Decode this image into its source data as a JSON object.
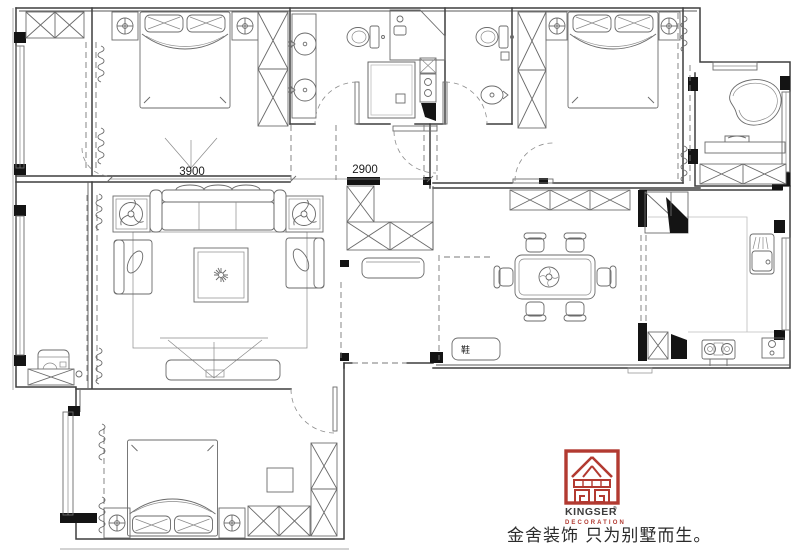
{
  "drawing": {
    "type": "residential floor plan",
    "dimensions": {
      "bedroom_width_label": "3900",
      "hallway_width_label": "2900"
    },
    "labels": {
      "shoe_cabinet": "鞋"
    }
  },
  "logo": {
    "brand": "KINGSER",
    "registered_mark": "®",
    "division": "DECORATION",
    "tagline": "金舍装饰 只为别墅而生。",
    "color_red": "#b23a31"
  },
  "colors": {
    "wall_line": "#3f3f3f",
    "furniture_line": "#6b6b6b",
    "background": "#ffffff"
  }
}
